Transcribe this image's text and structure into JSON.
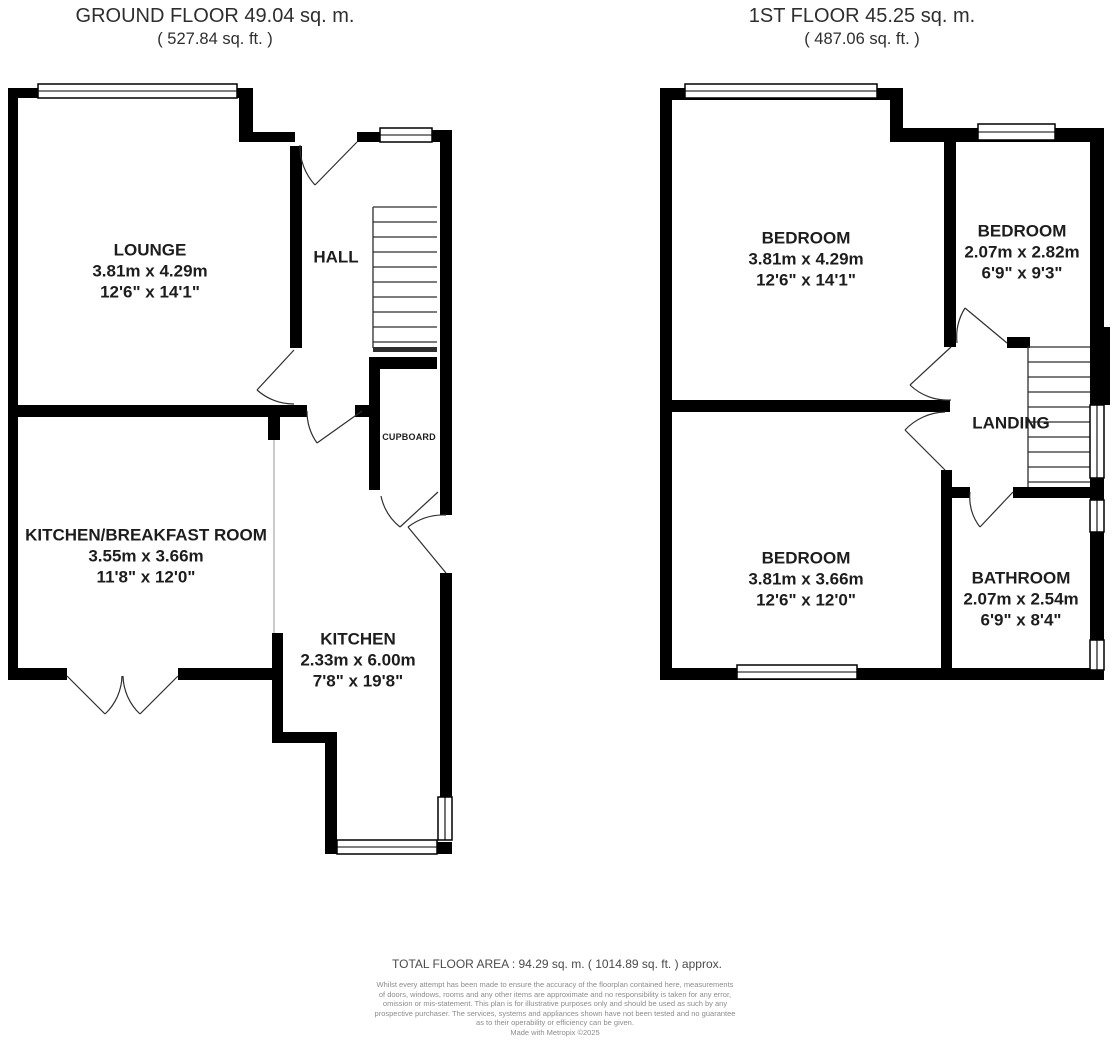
{
  "ground_floor": {
    "title": "GROUND FLOOR 49.04 sq. m.",
    "subtitle": "( 527.84 sq. ft. )",
    "rooms": {
      "lounge": {
        "name": "LOUNGE",
        "metric": "3.81m x 4.29m",
        "imperial": "12'6\" x 14'1\""
      },
      "hall": {
        "name": "HALL"
      },
      "cupboard": {
        "name": "CUPBOARD"
      },
      "kitchen_breakfast": {
        "name": "KITCHEN/BREAKFAST ROOM",
        "metric": "3.55m x 3.66m",
        "imperial": "11'8\" x 12'0\""
      },
      "kitchen": {
        "name": "KITCHEN",
        "metric": "2.33m x 6.00m",
        "imperial": "7'8\" x 19'8\""
      }
    }
  },
  "first_floor": {
    "title": "1ST FLOOR 45.25 sq. m.",
    "subtitle": "( 487.06 sq. ft. )",
    "rooms": {
      "bedroom_front": {
        "name": "BEDROOM",
        "metric": "3.81m x 4.29m",
        "imperial": "12'6\" x 14'1\""
      },
      "bedroom_side": {
        "name": "BEDROOM",
        "metric": "2.07m x 2.82m",
        "imperial": "6'9\" x 9'3\""
      },
      "bedroom_back": {
        "name": "BEDROOM",
        "metric": "3.81m x 3.66m",
        "imperial": "12'6\" x 12'0\""
      },
      "bathroom": {
        "name": "BATHROOM",
        "metric": "2.07m x 2.54m",
        "imperial": "6'9\" x 8'4\""
      },
      "landing": {
        "name": "LANDING"
      }
    }
  },
  "footer": {
    "total_area": "TOTAL FLOOR AREA : 94.29 sq. m. ( 1014.89 sq. ft. ) approx.",
    "disclaimer_lines": [
      "Whilst every attempt has been made to ensure the accuracy of the floorplan contained here, measurements",
      "of doors, windows, rooms and any other items are approximate and no responsibility is taken for any error,",
      "omission or mis-statement. This plan is for illustrative purposes only and should be used as such by any",
      "prospective purchaser. The services, systems and appliances shown have not been tested and no guarantee",
      "as to their operability or efficiency can be given."
    ],
    "credit": "Made with Metropix ©2025"
  },
  "colors": {
    "wall": "#000000",
    "label_text": "#1d1d1d",
    "plan_line": "#2e2e2e",
    "open_plan_divider": "#b5b5b5",
    "footer_text": "#4a4a4a",
    "disclaimer_text": "#8c8c8c",
    "background": "#ffffff"
  }
}
